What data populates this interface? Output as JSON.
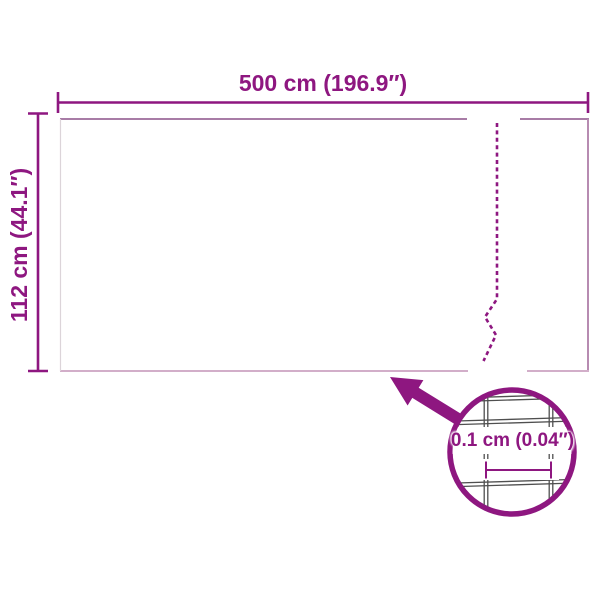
{
  "diagram": {
    "type": "product-dimension-diagram",
    "colors": {
      "accent": "#8E1780",
      "wire": "#4F4F4F"
    },
    "labels": {
      "width": "500 cm (196.9″)",
      "height": "112 cm (44.1″)",
      "detail": "0.1 cm (0.04″)"
    }
  }
}
